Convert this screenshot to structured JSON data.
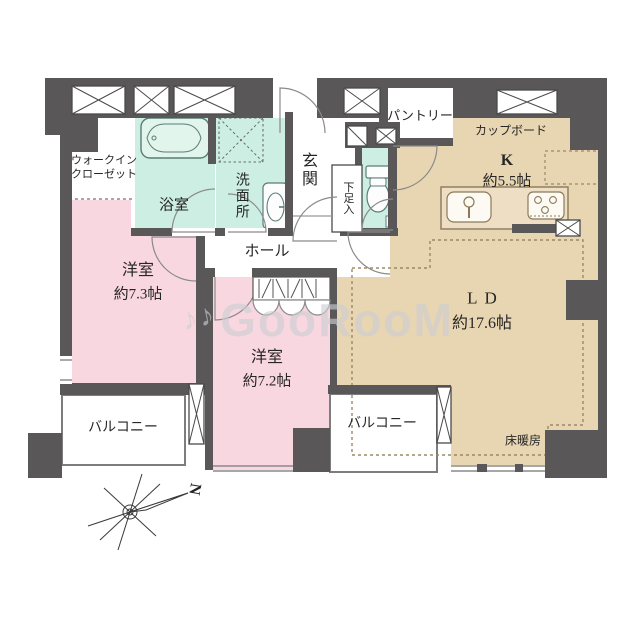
{
  "watermark": {
    "text": "GooRooM",
    "icon": "♪♪"
  },
  "compass": {
    "north_label": "N"
  },
  "colors": {
    "wall": "#595757",
    "bedroom_pink": "#f8d7e0",
    "wet_area_mint": "#cdeee2",
    "living_tan": "#e8d5b2"
  },
  "rooms": {
    "walk_in_closet": {
      "label": "ウォークイン\nクローゼット"
    },
    "bathroom": {
      "label": "浴室"
    },
    "washroom": {
      "label": "洗面所"
    },
    "entrance": {
      "label": "玄関"
    },
    "shoe_cabinet": {
      "label": "下足入"
    },
    "pantry": {
      "label": "パントリー"
    },
    "cupboard": {
      "label": "カップボード"
    },
    "kitchen": {
      "label": "K",
      "size": "約5.5帖"
    },
    "hall": {
      "label": "ホール"
    },
    "bedroom1": {
      "label": "洋室",
      "size": "約7.3帖"
    },
    "bedroom2": {
      "label": "洋室",
      "size": "約7.2帖"
    },
    "living_dining": {
      "label": "LD",
      "size": "約17.6帖"
    },
    "balcony_left": {
      "label": "バルコニー"
    },
    "balcony_center": {
      "label": "バルコニー"
    },
    "floor_heating": {
      "label": "床暖房"
    }
  }
}
